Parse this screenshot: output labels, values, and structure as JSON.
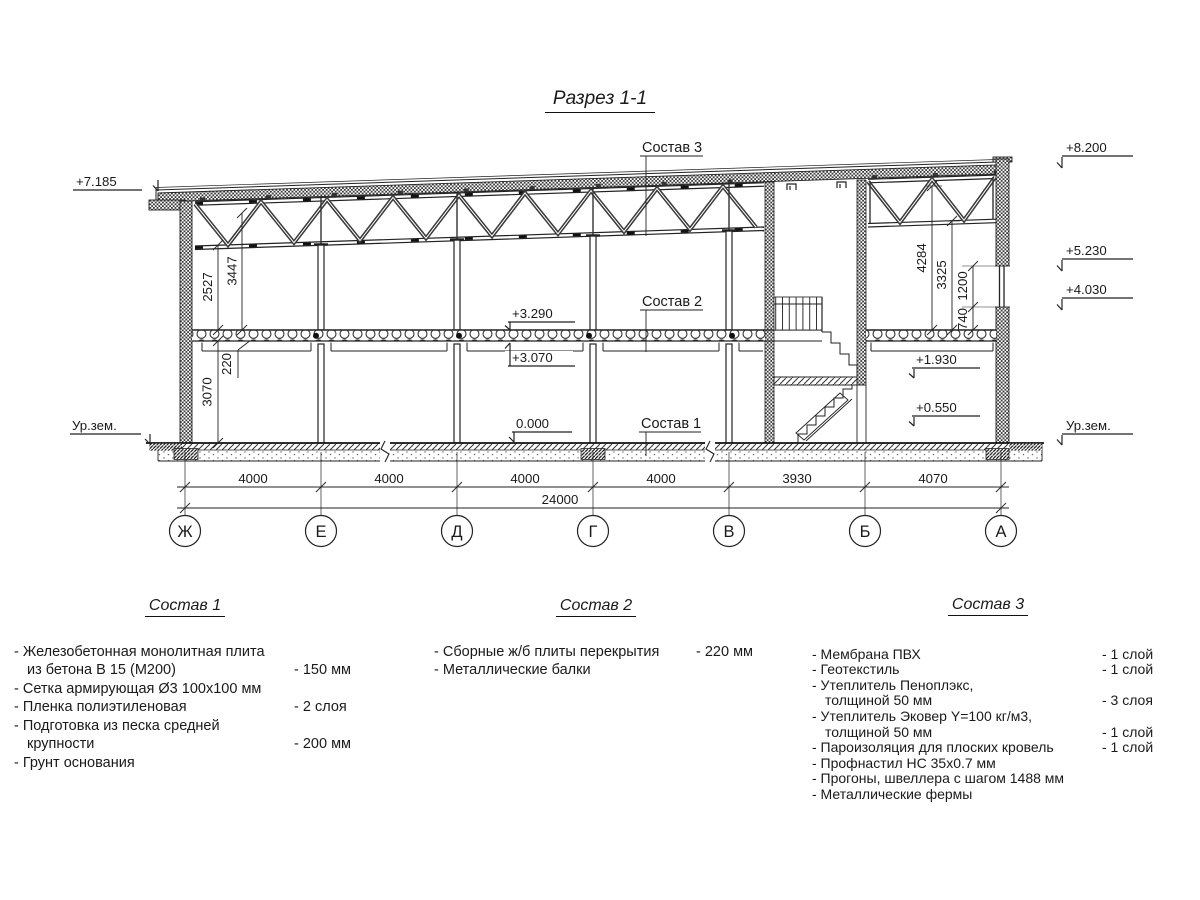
{
  "title": "Разрез 1-1",
  "section": {
    "callouts": {
      "c1": "Состав 1",
      "c2": "Состав 2",
      "c3": "Состав 3"
    },
    "elevations": {
      "eaves_left": "+7.185",
      "ground_left": "Ур.зем.",
      "parapet_right": "+8.200",
      "right_upper": "+5.230",
      "right_lower": "+4.030",
      "ground_right": "Ур.зем.",
      "slab_top": "+3.290",
      "slab_bottom": "+3.070",
      "floor_zero": "0.000",
      "platform_upper": "+1.930",
      "platform_lower": "+0.550"
    },
    "dims_left": {
      "truss_to_slab": "2527",
      "roof_to_slab": "3447",
      "slab_thickness": "220",
      "floor_height": "3070"
    },
    "dims_right": {
      "roof_to_slab": "4284",
      "truss_to_slab": "3325",
      "window_height": "1200",
      "sill_height": "740"
    },
    "spans": [
      "4000",
      "4000",
      "4000",
      "4000",
      "3930",
      "4070"
    ],
    "total_span": "24000",
    "axes": [
      "Ж",
      "Е",
      "Д",
      "Г",
      "В",
      "Б",
      "А"
    ]
  },
  "legends": [
    {
      "title": "Состав 1",
      "rows": [
        {
          "t": "- Железобетонная  монолитная плита",
          "v": ""
        },
        {
          "t": "из бетона В 15 (М200)",
          "v": "- 150 мм"
        },
        {
          "t": "- Сетка армирующая Ø3 100х100 мм",
          "v": ""
        },
        {
          "t": "- Пленка полиэтиленовая",
          "v": "-  2 слоя"
        },
        {
          "t": "- Подготовка из песка средней",
          "v": ""
        },
        {
          "t": "крупности",
          "v": "- 200 мм"
        },
        {
          "t": "- Грунт основания",
          "v": ""
        }
      ]
    },
    {
      "title": "Состав 2",
      "rows": [
        {
          "t": "- Сборные ж/б плиты перекрытия",
          "v": "- 220 мм"
        },
        {
          "t": "- Металлические балки",
          "v": ""
        }
      ]
    },
    {
      "title": "Состав 3",
      "rows": [
        {
          "t": "- Мембрана ПВХ",
          "v": "- 1 слой"
        },
        {
          "t": "- Геотекстиль",
          "v": "- 1 слой"
        },
        {
          "t": "- Утеплитель Пеноплэкс,",
          "v": ""
        },
        {
          "t": "толщиной 50 мм",
          "v": "- 3 слоя"
        },
        {
          "t": "- Утеплитель Эковер Y=100 кг/м3,",
          "v": ""
        },
        {
          "t": "толщиной 50 мм",
          "v": "- 1 слой"
        },
        {
          "t": "- Пароизоляция для плоских кровель",
          "v": "- 1 слой"
        },
        {
          "t": "- Профнастил НС 35х0.7 мм",
          "v": ""
        },
        {
          "t": "- Прогоны, швеллера с шагом 1488 мм",
          "v": ""
        },
        {
          "t": "- Металлические фермы",
          "v": ""
        }
      ]
    }
  ]
}
